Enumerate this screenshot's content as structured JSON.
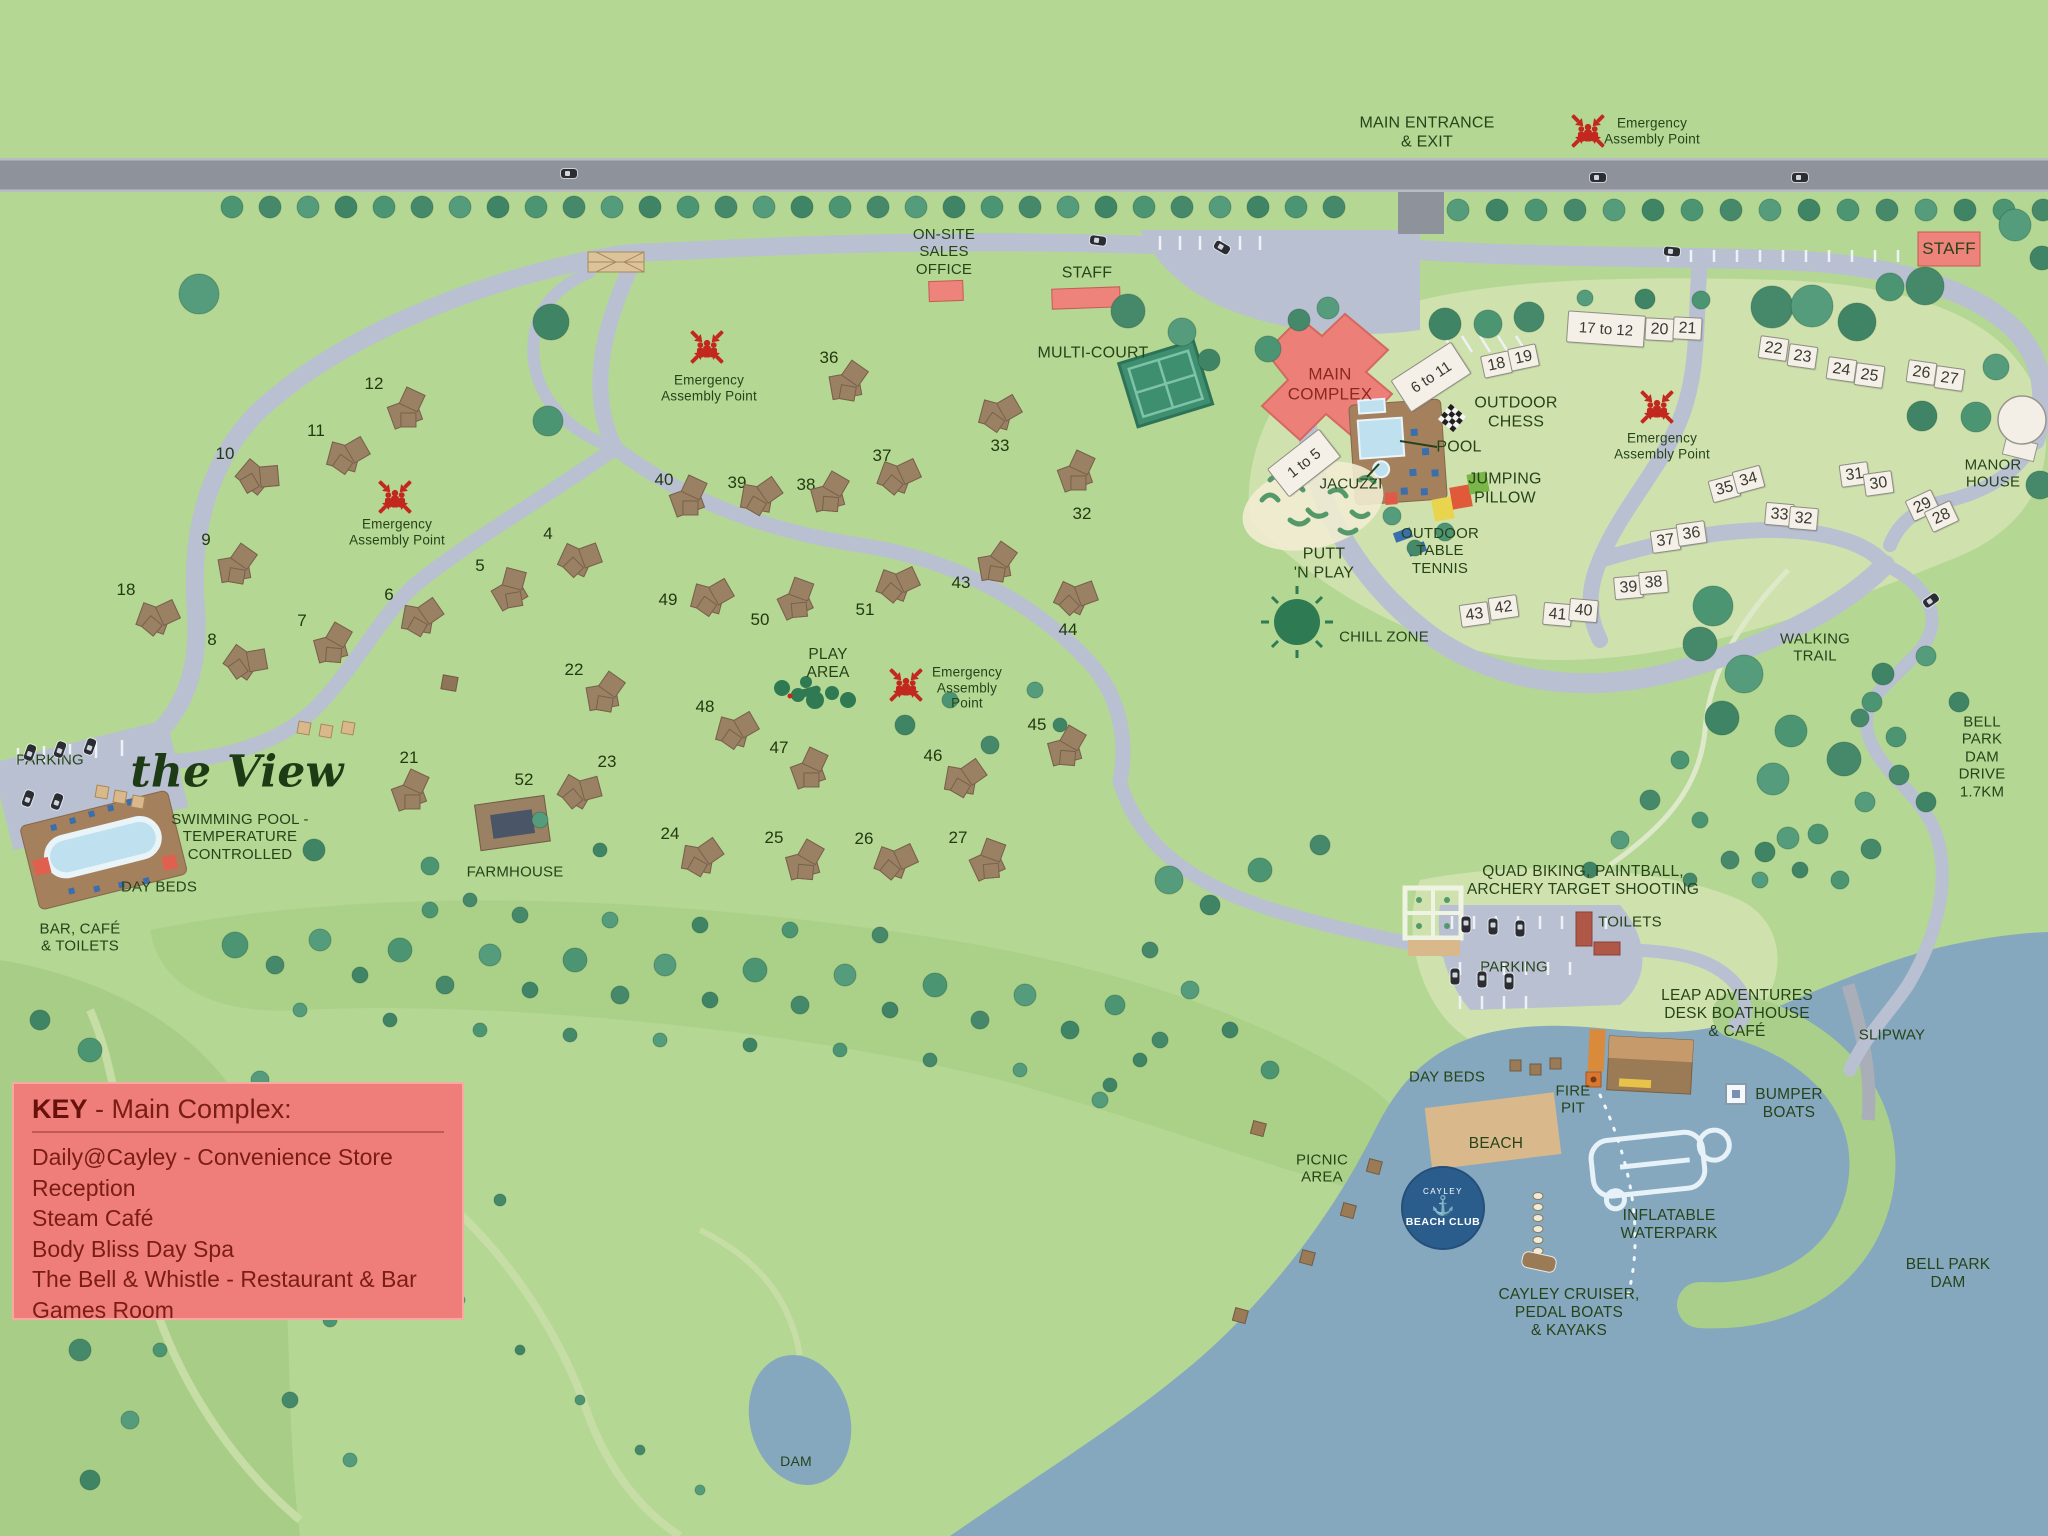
{
  "colors": {
    "grass": "#b4d793",
    "grass_dark": "#a8cd86",
    "grass_pale": "#cfe2ae",
    "road_main": "#8e929b",
    "road_internal": "#b9c0d2",
    "water": "#85a8bf",
    "beach_sand": "#d9b98c",
    "lodge_brown": "#9b8164",
    "lodge_white": "#f4efe7",
    "building_red": "#ee837b",
    "tree_green": "#4c9573",
    "label_green": "#27431a",
    "key_bg": "#ef7e7a",
    "key_text": "#7a1d14",
    "logo_blue": "#2b5d8c",
    "assembly_red": "#c3281e"
  },
  "key_box": {
    "title_bold": "KEY",
    "title_rest": " - Main Complex:",
    "items": [
      "Daily@Cayley - Convenience Store",
      "Reception",
      "Steam Café",
      "Body Bliss Day Spa",
      "The Bell & Whistle - Restaurant & Bar",
      "Games Room"
    ]
  },
  "beach_club": {
    "top": "CAYLEY",
    "anchor": "⚓",
    "name": "BEACH CLUB"
  },
  "labels": [
    {
      "id": "main-entrance",
      "text": "MAIN ENTRANCE\n& EXIT",
      "x": 1427,
      "y": 133,
      "fs": 16
    },
    {
      "id": "sales-office",
      "text": "ON-SITE\nSALES\nOFFICE",
      "x": 944,
      "y": 252,
      "fs": 15
    },
    {
      "id": "staff-center",
      "text": "STAFF",
      "x": 1087,
      "y": 274,
      "fs": 16
    },
    {
      "id": "staff-right",
      "text": "STAFF",
      "x": 1949,
      "y": 249,
      "fs": 17
    },
    {
      "id": "multi-court",
      "text": "MULTI-COURT",
      "x": 1093,
      "y": 354,
      "fs": 16
    },
    {
      "id": "main-complex",
      "text": "MAIN\nCOMPLEX",
      "x": 1330,
      "y": 384,
      "fs": 17,
      "color": "#8c2620"
    },
    {
      "id": "outdoor-chess",
      "text": "OUTDOOR\nCHESS",
      "x": 1516,
      "y": 413,
      "fs": 16
    },
    {
      "id": "pool",
      "text": "POOL",
      "x": 1459,
      "y": 448,
      "fs": 16
    },
    {
      "id": "jacuzzi",
      "text": "JACUZZI",
      "x": 1351,
      "y": 484,
      "fs": 15
    },
    {
      "id": "jumping-pillow",
      "text": "JUMPING\nPILLOW",
      "x": 1505,
      "y": 489,
      "fs": 16
    },
    {
      "id": "outdoor-table-tennis",
      "text": "OUTDOOR\nTABLE\nTENNIS",
      "x": 1440,
      "y": 551,
      "fs": 15
    },
    {
      "id": "putt-n-play",
      "text": "PUTT\n'N PLAY",
      "x": 1324,
      "y": 564,
      "fs": 16
    },
    {
      "id": "chill-zone",
      "text": "CHILL ZONE",
      "x": 1384,
      "y": 637,
      "fs": 15
    },
    {
      "id": "manor-house",
      "text": "MANOR\nHOUSE",
      "x": 1993,
      "y": 474,
      "fs": 15
    },
    {
      "id": "walking-trail",
      "text": "WALKING\nTRAIL",
      "x": 1815,
      "y": 648,
      "fs": 15
    },
    {
      "id": "bell-park-dam-drive",
      "text": "BELL PARK\nDAM\nDRIVE\n1.7KM",
      "x": 1982,
      "y": 757,
      "fs": 15
    },
    {
      "id": "parking-left",
      "text": "PARKING",
      "x": 50,
      "y": 760,
      "fs": 15
    },
    {
      "id": "swimming-pool",
      "text": "SWIMMING POOL -\nTEMPERATURE\nCONTROLLED",
      "x": 240,
      "y": 837,
      "fs": 15
    },
    {
      "id": "day-beds-left",
      "text": "DAY BEDS",
      "x": 159,
      "y": 887,
      "fs": 15
    },
    {
      "id": "bar-cafe-toilets",
      "text": "BAR, CAFÉ\n& TOILETS",
      "x": 80,
      "y": 938,
      "fs": 15
    },
    {
      "id": "farmhouse",
      "text": "FARMHOUSE",
      "x": 515,
      "y": 872,
      "fs": 15
    },
    {
      "id": "dam",
      "text": "DAM",
      "x": 796,
      "y": 1461,
      "fs": 14
    },
    {
      "id": "quad-biking",
      "text": "QUAD BIKING, PAINTBALL,\nARCHERY TARGET SHOOTING",
      "x": 1583,
      "y": 881,
      "fs": 15.5
    },
    {
      "id": "toilets",
      "text": "TOILETS",
      "x": 1630,
      "y": 922,
      "fs": 15
    },
    {
      "id": "parking-right",
      "text": "PARKING",
      "x": 1514,
      "y": 967,
      "fs": 15
    },
    {
      "id": "leap-adventures",
      "text": "LEAP ADVENTURES\nDESK BOATHOUSE\n& CAFÉ",
      "x": 1737,
      "y": 1014,
      "fs": 15.5
    },
    {
      "id": "slipway",
      "text": "SLIPWAY",
      "x": 1892,
      "y": 1035,
      "fs": 15
    },
    {
      "id": "day-beds-beach",
      "text": "DAY BEDS",
      "x": 1447,
      "y": 1077,
      "fs": 15
    },
    {
      "id": "fire-pit",
      "text": "FIRE\nPIT",
      "x": 1573,
      "y": 1100,
      "fs": 15
    },
    {
      "id": "bumper-boats",
      "text": "BUMPER\nBOATS",
      "x": 1789,
      "y": 1104,
      "fs": 15.5
    },
    {
      "id": "beach",
      "text": "BEACH",
      "x": 1496,
      "y": 1144,
      "fs": 15.5
    },
    {
      "id": "picnic-area",
      "text": "PICNIC\nAREA",
      "x": 1322,
      "y": 1169,
      "fs": 15
    },
    {
      "id": "inflatable-waterpark",
      "text": "INFLATABLE\nWATERPARK",
      "x": 1669,
      "y": 1225,
      "fs": 15.5
    },
    {
      "id": "cayley-cruiser",
      "text": "CAYLEY CRUISER,\nPEDAL BOATS\n& KAYAKS",
      "x": 1569,
      "y": 1313,
      "fs": 15.5
    },
    {
      "id": "bell-park-dam",
      "text": "BELL PARK\nDAM",
      "x": 1948,
      "y": 1274,
      "fs": 15.5
    },
    {
      "id": "play-area",
      "text": "PLAY\nAREA",
      "x": 828,
      "y": 664,
      "fs": 15.5
    },
    {
      "id": "the-view",
      "text": "the View",
      "x": 237,
      "y": 772,
      "fs": 44,
      "script": true
    }
  ],
  "assembly_points": [
    {
      "x": 1588,
      "y": 131,
      "lx": 1652,
      "ly": 131,
      "text": "Emergency\nAssembly Point"
    },
    {
      "x": 395,
      "y": 497,
      "lx": 397,
      "ly": 532,
      "text": "Emergency\nAssembly Point"
    },
    {
      "x": 707,
      "y": 347,
      "lx": 709,
      "ly": 388,
      "text": "Emergency\nAssembly Point"
    },
    {
      "x": 906,
      "y": 685,
      "lx": 967,
      "ly": 688,
      "text": "Emergency\nAssembly\nPoint"
    },
    {
      "x": 1657,
      "y": 407,
      "lx": 1662,
      "ly": 446,
      "text": "Emergency\nAssembly Point"
    }
  ],
  "white_lodges": [
    {
      "n": "1 to 5",
      "x": 1303,
      "y": 462,
      "w": 64,
      "h": 34,
      "rot": -38,
      "fs": 15
    },
    {
      "n": "6 to 11",
      "x": 1430,
      "y": 376,
      "w": 70,
      "h": 36,
      "rot": -33,
      "fs": 15
    },
    {
      "n": "17 to 12",
      "x": 1605,
      "y": 328,
      "w": 76,
      "h": 30,
      "rot": 4,
      "fs": 15
    },
    {
      "n": "18",
      "x": 1495,
      "y": 363,
      "rot": -12
    },
    {
      "n": "19",
      "x": 1522,
      "y": 356,
      "rot": -12
    },
    {
      "n": "20",
      "x": 1658,
      "y": 328,
      "rot": 3
    },
    {
      "n": "21",
      "x": 1686,
      "y": 327,
      "rot": 3
    },
    {
      "n": "22",
      "x": 1772,
      "y": 347,
      "rot": 8
    },
    {
      "n": "23",
      "x": 1801,
      "y": 355,
      "rot": 8
    },
    {
      "n": "24",
      "x": 1840,
      "y": 368,
      "rot": 8
    },
    {
      "n": "25",
      "x": 1868,
      "y": 374,
      "rot": 8
    },
    {
      "n": "26",
      "x": 1920,
      "y": 371,
      "rot": 8
    },
    {
      "n": "27",
      "x": 1948,
      "y": 377,
      "rot": 8
    },
    {
      "n": "31",
      "x": 1853,
      "y": 473,
      "rot": -8
    },
    {
      "n": "30",
      "x": 1877,
      "y": 482,
      "rot": -8
    },
    {
      "n": "29",
      "x": 1921,
      "y": 504,
      "rot": -25
    },
    {
      "n": "28",
      "x": 1940,
      "y": 515,
      "rot": -25
    },
    {
      "n": "35",
      "x": 1723,
      "y": 487,
      "rot": -15
    },
    {
      "n": "34",
      "x": 1747,
      "y": 478,
      "rot": -15
    },
    {
      "n": "33",
      "x": 1778,
      "y": 513,
      "rot": 5
    },
    {
      "n": "32",
      "x": 1802,
      "y": 517,
      "rot": 5
    },
    {
      "n": "37",
      "x": 1664,
      "y": 539,
      "rot": -8
    },
    {
      "n": "36",
      "x": 1690,
      "y": 532,
      "rot": -8
    },
    {
      "n": "39",
      "x": 1627,
      "y": 586,
      "rot": -5
    },
    {
      "n": "38",
      "x": 1652,
      "y": 581,
      "rot": -5
    },
    {
      "n": "43",
      "x": 1473,
      "y": 613,
      "rot": -8
    },
    {
      "n": "42",
      "x": 1502,
      "y": 606,
      "rot": -8
    },
    {
      "n": "41",
      "x": 1556,
      "y": 613,
      "rot": 5
    },
    {
      "n": "40",
      "x": 1582,
      "y": 609,
      "rot": 5
    }
  ],
  "brown_lodges": [
    {
      "n": "12",
      "x": 374,
      "y": 384,
      "bx": 408,
      "by": 410,
      "rot": -20
    },
    {
      "n": "11",
      "x": 316,
      "y": 431,
      "bx": 348,
      "by": 456,
      "rot": 15
    },
    {
      "n": "10",
      "x": 225,
      "y": 454,
      "bx": 258,
      "by": 478,
      "rot": 40
    },
    {
      "n": "9",
      "x": 206,
      "y": 540,
      "bx": 238,
      "by": 566,
      "rot": -10
    },
    {
      "n": "18",
      "x": 126,
      "y": 590,
      "bx": 158,
      "by": 618,
      "rot": 20
    },
    {
      "n": "8",
      "x": 212,
      "y": 640,
      "bx": 246,
      "by": 663,
      "rot": 35
    },
    {
      "n": "7",
      "x": 302,
      "y": 621,
      "bx": 334,
      "by": 645,
      "rot": -15
    },
    {
      "n": "6",
      "x": 389,
      "y": 595,
      "bx": 422,
      "by": 618,
      "rot": 10
    },
    {
      "n": "5",
      "x": 480,
      "y": 566,
      "bx": 512,
      "by": 590,
      "rot": -30
    },
    {
      "n": "4",
      "x": 548,
      "y": 534,
      "bx": 580,
      "by": 560,
      "rot": 25
    },
    {
      "n": "22",
      "x": 574,
      "y": 670,
      "bx": 606,
      "by": 694,
      "rot": -10
    },
    {
      "n": "23",
      "x": 607,
      "y": 762,
      "bx": 580,
      "by": 792,
      "rot": 30
    },
    {
      "n": "21",
      "x": 409,
      "y": 758,
      "bx": 412,
      "by": 792,
      "rot": -20
    },
    {
      "n": "24",
      "x": 670,
      "y": 834,
      "bx": 702,
      "by": 858,
      "rot": 10
    },
    {
      "n": "25",
      "x": 774,
      "y": 838,
      "bx": 806,
      "by": 862,
      "rot": -15
    },
    {
      "n": "26",
      "x": 864,
      "y": 839,
      "bx": 896,
      "by": 862,
      "rot": 20
    },
    {
      "n": "27",
      "x": 958,
      "y": 838,
      "bx": 990,
      "by": 861,
      "rot": -25
    },
    {
      "n": "48",
      "x": 705,
      "y": 707,
      "bx": 737,
      "by": 731,
      "rot": 15
    },
    {
      "n": "47",
      "x": 779,
      "y": 748,
      "bx": 811,
      "by": 770,
      "rot": -20
    },
    {
      "n": "46",
      "x": 933,
      "y": 756,
      "bx": 965,
      "by": 779,
      "rot": 10
    },
    {
      "n": "45",
      "x": 1037,
      "y": 725,
      "bx": 1068,
      "by": 748,
      "rot": -15
    },
    {
      "n": "44",
      "x": 1068,
      "y": 630,
      "bx": 1076,
      "by": 598,
      "rot": 25
    },
    {
      "n": "43",
      "x": 961,
      "y": 583,
      "bx": 998,
      "by": 564,
      "rot": -10
    },
    {
      "n": "51",
      "x": 865,
      "y": 610,
      "bx": 898,
      "by": 585,
      "rot": 20
    },
    {
      "n": "50",
      "x": 760,
      "y": 620,
      "bx": 798,
      "by": 600,
      "rot": -25
    },
    {
      "n": "49",
      "x": 668,
      "y": 600,
      "bx": 712,
      "by": 598,
      "rot": 15
    },
    {
      "n": "40",
      "x": 664,
      "y": 480,
      "bx": 690,
      "by": 498,
      "rot": -20
    },
    {
      "n": "39",
      "x": 737,
      "y": 483,
      "bx": 761,
      "by": 497,
      "rot": 10
    },
    {
      "n": "38",
      "x": 806,
      "y": 485,
      "bx": 831,
      "by": 494,
      "rot": -15
    },
    {
      "n": "37",
      "x": 882,
      "y": 456,
      "bx": 899,
      "by": 477,
      "rot": 20
    },
    {
      "n": "36",
      "x": 829,
      "y": 358,
      "bx": 849,
      "by": 383,
      "rot": -10
    },
    {
      "n": "33",
      "x": 1000,
      "y": 446,
      "bx": 1000,
      "by": 414,
      "rot": 15
    },
    {
      "n": "32",
      "x": 1082,
      "y": 514,
      "bx": 1078,
      "by": 473,
      "rot": -20
    },
    {
      "n": "52",
      "x": 524,
      "y": 780,
      "plain": true
    }
  ]
}
